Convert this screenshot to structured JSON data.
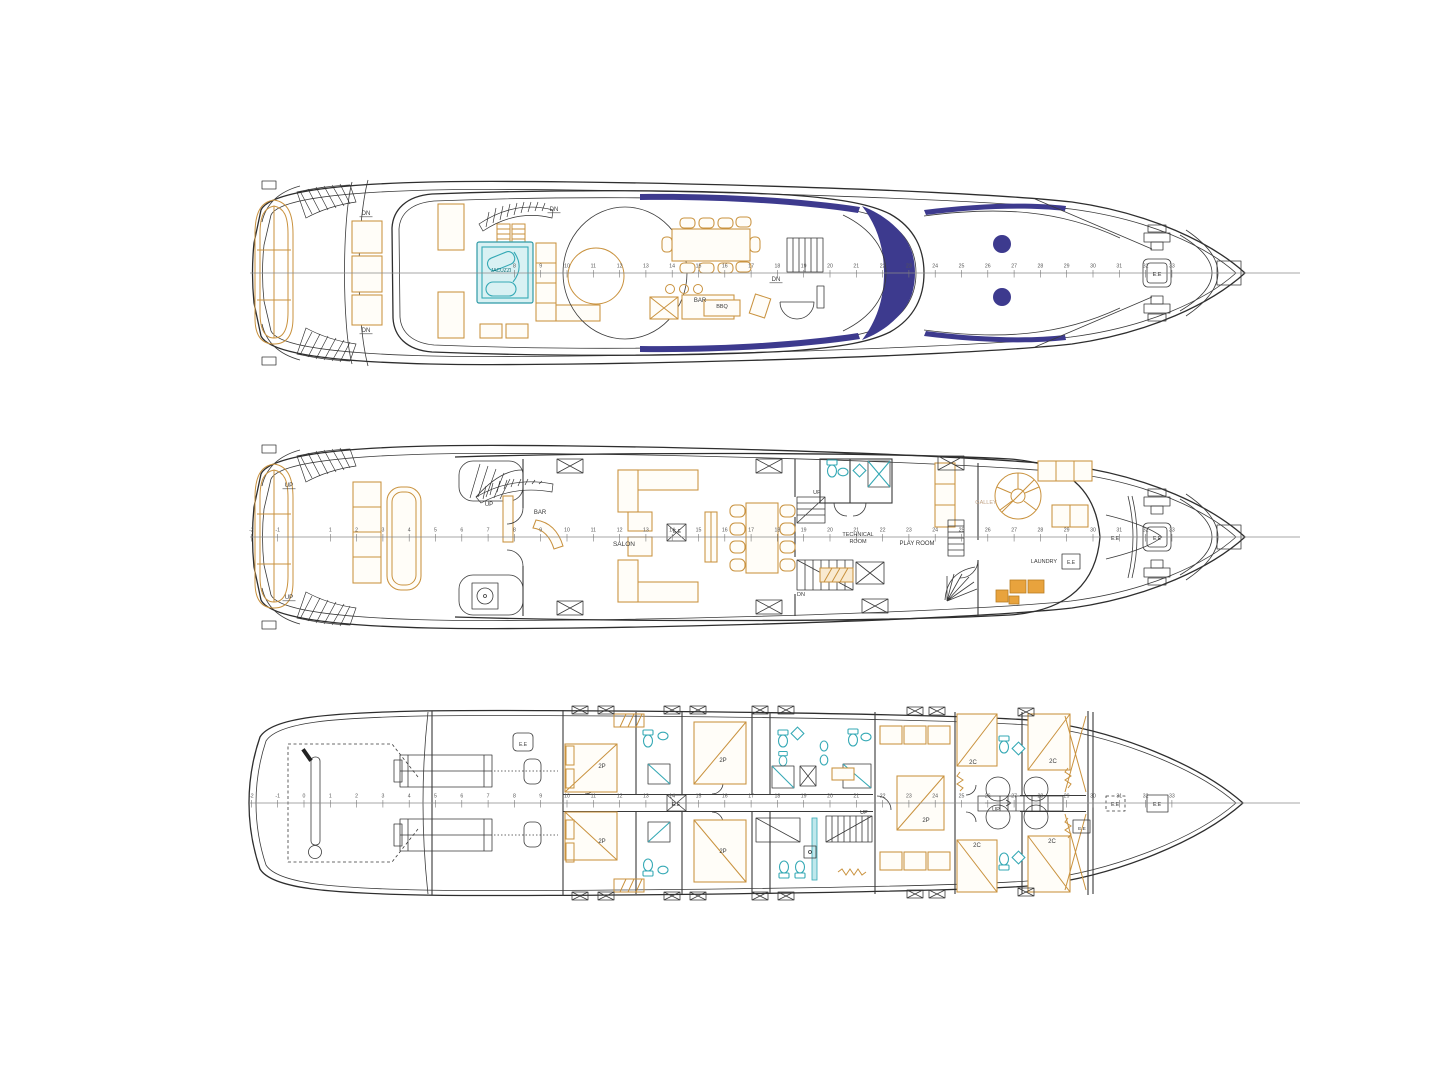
{
  "colors": {
    "paper": "#ffffff",
    "hull_line": "#2e2e2e",
    "furniture_orange": "#c9923e",
    "fixture_teal": "#35a9b5",
    "glass_navy": "#3d3a8e",
    "ruler_gray": "#555555",
    "galley_text": "#c2a487",
    "jacuzzi_text": "#136f76"
  },
  "decks": [
    {
      "id": "sun-deck",
      "cy": 273,
      "ruler": {
        "x0": 250,
        "x1": 1300,
        "origin": 304,
        "step": 26.3,
        "stations": [
          8,
          9,
          10,
          11,
          12,
          13,
          14,
          15,
          16,
          17,
          18,
          19,
          20,
          21,
          22,
          23,
          24,
          25,
          26,
          27,
          28,
          29,
          30,
          31,
          32,
          33
        ]
      },
      "labels": [
        {
          "text": "DN",
          "x": 366,
          "y": 215,
          "size": 6,
          "underline": true
        },
        {
          "text": "DN",
          "x": 366,
          "y": 332,
          "size": 6,
          "underline": true
        },
        {
          "text": "DN",
          "x": 554,
          "y": 211,
          "size": 6,
          "underline": true
        },
        {
          "text": "DN",
          "x": 776,
          "y": 281,
          "size": 6,
          "underline": true
        },
        {
          "text": "JACUZZI",
          "x": 501,
          "y": 272,
          "size": 5,
          "color": "#136f76"
        },
        {
          "text": "BAR",
          "x": 700,
          "y": 302,
          "size": 6
        },
        {
          "text": "BBQ",
          "x": 722,
          "y": 308,
          "size": 5.5
        },
        {
          "text": "E.E",
          "x": 1157,
          "y": 276,
          "size": 5.5
        }
      ]
    },
    {
      "id": "main-deck",
      "cy": 537,
      "ruler": {
        "x0": 250,
        "x1": 1300,
        "origin": 304,
        "step": 26.3,
        "stations": [
          -2,
          -1,
          1,
          2,
          3,
          4,
          5,
          6,
          7,
          8,
          9,
          10,
          11,
          12,
          13,
          14,
          15,
          16,
          17,
          18,
          19,
          20,
          21,
          22,
          23,
          24,
          25,
          26,
          27,
          28,
          29,
          30,
          31,
          32,
          33
        ]
      },
      "labels": [
        {
          "text": "UP",
          "x": 289,
          "y": 487,
          "size": 6,
          "underline": true
        },
        {
          "text": "UP",
          "x": 289,
          "y": 599,
          "size": 6,
          "underline": true
        },
        {
          "text": "UP",
          "x": 489,
          "y": 506,
          "size": 6
        },
        {
          "text": "BAR",
          "x": 540,
          "y": 514,
          "size": 6
        },
        {
          "text": "SALON",
          "x": 624,
          "y": 546,
          "size": 6.5
        },
        {
          "text": "E.E",
          "x": 677,
          "y": 533,
          "size": 5
        },
        {
          "text": "UP",
          "x": 817,
          "y": 494,
          "size": 5.5
        },
        {
          "text": "DN",
          "x": 801,
          "y": 596,
          "size": 5.5
        },
        {
          "text": "TECHNICAL",
          "x": 858,
          "y": 536,
          "size": 5.5
        },
        {
          "text": "ROOM",
          "x": 858,
          "y": 543,
          "size": 5.5
        },
        {
          "text": "PLAY ROOM",
          "x": 917,
          "y": 545,
          "size": 6
        },
        {
          "text": "GALLEY",
          "x": 986,
          "y": 504,
          "size": 5.5,
          "color": "#c2a487"
        },
        {
          "text": "LAUNDRY",
          "x": 1044,
          "y": 563,
          "size": 5.5
        },
        {
          "text": "E.E",
          "x": 1071,
          "y": 564,
          "size": 5
        },
        {
          "text": "E.E",
          "x": 1115,
          "y": 540,
          "size": 5
        },
        {
          "text": "E.E",
          "x": 1157,
          "y": 540,
          "size": 5
        }
      ]
    },
    {
      "id": "lower-deck",
      "cy": 803,
      "ruler": {
        "x0": 250,
        "x1": 1300,
        "origin": 304,
        "step": 26.3,
        "stations": [
          -2,
          -1,
          0,
          1,
          2,
          3,
          4,
          5,
          6,
          7,
          8,
          9,
          10,
          11,
          12,
          13,
          14,
          15,
          16,
          17,
          18,
          19,
          20,
          21,
          22,
          23,
          24,
          25,
          26,
          27,
          28,
          29,
          30,
          31,
          32,
          33
        ]
      },
      "labels": [
        {
          "text": "E.E",
          "x": 523,
          "y": 746,
          "size": 5
        },
        {
          "text": "2P",
          "x": 602,
          "y": 768,
          "size": 6
        },
        {
          "text": "2P",
          "x": 602,
          "y": 843,
          "size": 6
        },
        {
          "text": "2P",
          "x": 723,
          "y": 762,
          "size": 6
        },
        {
          "text": "2P",
          "x": 723,
          "y": 853,
          "size": 6
        },
        {
          "text": "2P",
          "x": 926,
          "y": 822,
          "size": 6
        },
        {
          "text": "2C",
          "x": 973,
          "y": 764,
          "size": 6
        },
        {
          "text": "2C",
          "x": 1053,
          "y": 763,
          "size": 6
        },
        {
          "text": "2C",
          "x": 977,
          "y": 847,
          "size": 6
        },
        {
          "text": "2C",
          "x": 1052,
          "y": 843,
          "size": 6
        },
        {
          "text": "UP",
          "x": 864,
          "y": 814,
          "size": 5.5
        },
        {
          "text": "UP",
          "x": 996,
          "y": 811,
          "size": 5.5
        },
        {
          "text": "E.E",
          "x": 676,
          "y": 806,
          "size": 5
        },
        {
          "text": "E.E",
          "x": 1082,
          "y": 830,
          "size": 4.8
        },
        {
          "text": "E.E",
          "x": 1115,
          "y": 806,
          "size": 5
        },
        {
          "text": "E.E",
          "x": 1157,
          "y": 806,
          "size": 5
        }
      ]
    }
  ]
}
